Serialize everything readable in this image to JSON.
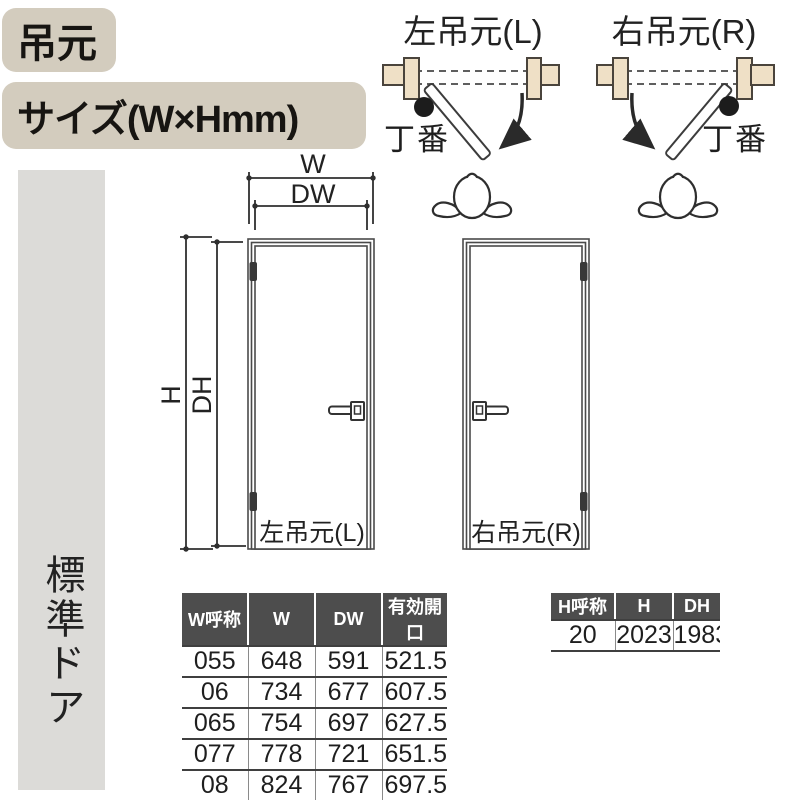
{
  "header": {
    "hinge_label": "吊元",
    "size_label": "サイズ(W×Hmm)"
  },
  "sidebar": {
    "label": "標準ドア"
  },
  "swing": {
    "left": {
      "title": "左吊元(L)",
      "hinge_note": "丁番"
    },
    "right": {
      "title": "右吊元(R)",
      "hinge_note": "丁番"
    }
  },
  "doors": {
    "left_label": "左吊元(L)",
    "right_label": "右吊元(R)",
    "dims": {
      "w": "W",
      "dw": "DW",
      "h": "H",
      "dh": "DH"
    }
  },
  "tables": {
    "width": {
      "headers": [
        "W呼称",
        "W",
        "DW",
        "有効開口"
      ],
      "rows": [
        [
          "055",
          "648",
          "591",
          "521.5"
        ],
        [
          "06",
          "734",
          "677",
          "607.5"
        ],
        [
          "065",
          "754",
          "697",
          "627.5"
        ],
        [
          "077",
          "778",
          "721",
          "651.5"
        ],
        [
          "08",
          "824",
          "767",
          "697.5"
        ],
        [
          "09",
          "868",
          "811",
          "741.5"
        ]
      ]
    },
    "height": {
      "headers": [
        "H呼称",
        "H",
        "DH"
      ],
      "rows": [
        [
          "20",
          "2023",
          "1983"
        ]
      ]
    }
  },
  "colors": {
    "label_bg": "#d3ccbe",
    "sidebar_bg": "#dcdbd8",
    "wall_fill": "#efe0c6",
    "table_header_bg": "#4d4d4d",
    "line": "#3c3c3c"
  }
}
